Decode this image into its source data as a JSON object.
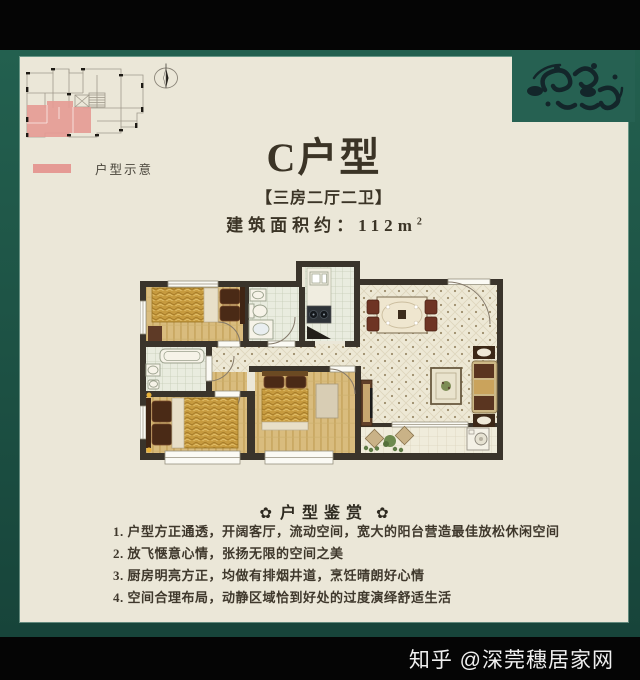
{
  "colors": {
    "frame_teal": "#23604f",
    "frame_teal_dark": "#17443a",
    "ornament_teal": "#266152",
    "ornament_dark": "#13262a",
    "panel_cream": "#ebe7d8",
    "bar_black": "#050505",
    "highlight_pink": "#e59a94",
    "text_dark": "#3b3426",
    "wall": "#3a342b",
    "watermark_white": "#f0f0f0"
  },
  "key_plan": {
    "legend_label": "户型示意"
  },
  "header": {
    "title": "C户型",
    "subtitle": "【三房二厅二卫】",
    "area_label": "建筑面积约：",
    "area_number": "112",
    "area_unit": "m",
    "area_exponent": "2"
  },
  "appreciation": {
    "heading": "户型鉴赏",
    "ornament_glyph": "✿",
    "items": [
      "1. 户型方正通透，开阔客厅，流动空间，宽大的阳台营造最佳放松休闲空间",
      "2. 放飞惬意心情，张扬无限的空间之美",
      "3. 厨房明亮方正，均做有排烟井道，烹饪晴朗好心情",
      "4. 空间合理布局，动静区域恰到好处的过度演绎舒适生活"
    ]
  },
  "watermark": {
    "text": "知乎 @深莞穗居家网"
  }
}
